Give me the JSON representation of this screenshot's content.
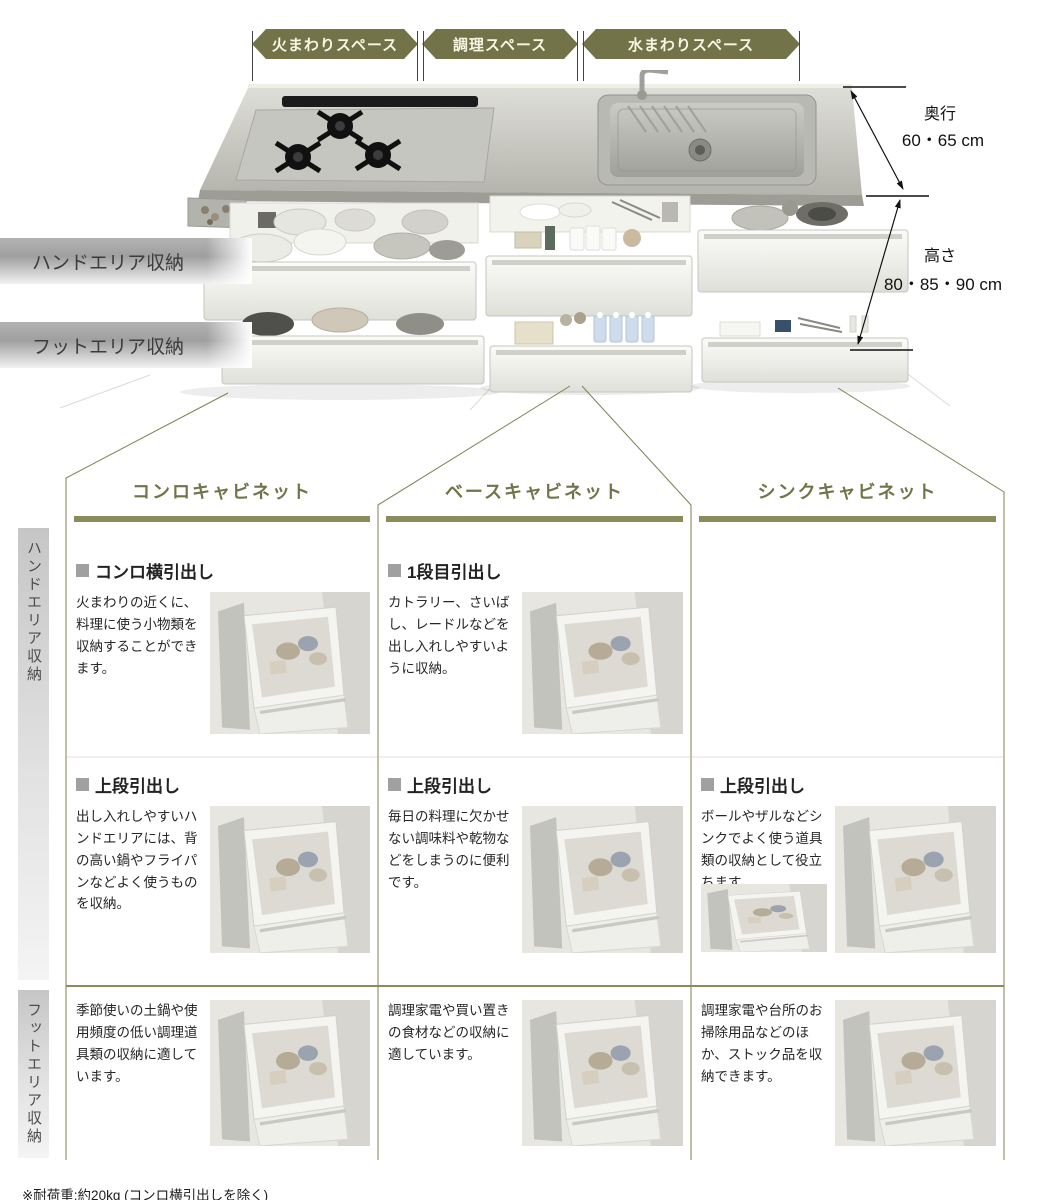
{
  "top_labels": {
    "fire": "火まわりスペース",
    "cook": "調理スペース",
    "water": "水まわりスペース"
  },
  "dimensions": {
    "depth_label": "奥行",
    "depth_value": "60・65 cm",
    "height_label": "高さ",
    "height_value": "80・85・90 cm"
  },
  "area_labels": {
    "hand": "ハンドエリア収納",
    "foot": "フットエリア収納"
  },
  "columns": [
    {
      "title": "コンロキャビネット",
      "hand_sections": [
        {
          "heading": "コンロ横引出し",
          "body": "火まわりの近くに、料理に使う小物類を収納することができます。"
        },
        {
          "heading": "上段引出し",
          "body": "出し入れしやすいハンドエリアには、背の高い鍋やフライパンなどよく使うものを収納。"
        }
      ],
      "foot_text": "季節使いの土鍋や使用頻度の低い調理道具類の収納に適しています。"
    },
    {
      "title": "ベースキャビネット",
      "hand_sections": [
        {
          "heading": "1段目引出し",
          "body": "カトラリー、さいばし、レードルなどを出し入れしやすいように収納。"
        },
        {
          "heading": "上段引出し",
          "body": "毎日の料理に欠かせない調味料や乾物などをしまうのに便利です。"
        }
      ],
      "foot_text": "調理家電や買い置きの食材などの収納に適しています。"
    },
    {
      "title": "シンクキャビネット",
      "hand_sections": [
        {
          "heading": "上段引出し",
          "body": "ボールやザルなどシンクでよく使う道具類の収納として役立ちます。"
        }
      ],
      "foot_text": "調理家電や台所のお掃除用品などのほか、ストック品を収納できます。"
    }
  ],
  "footnote": "※耐荷重:約20kg (コンロ横引出しを除く)",
  "colors": {
    "accent_olive": "#73734a",
    "accent_olive_light": "#8b8b5c",
    "area_bar_gray": "#a8a8a8"
  }
}
